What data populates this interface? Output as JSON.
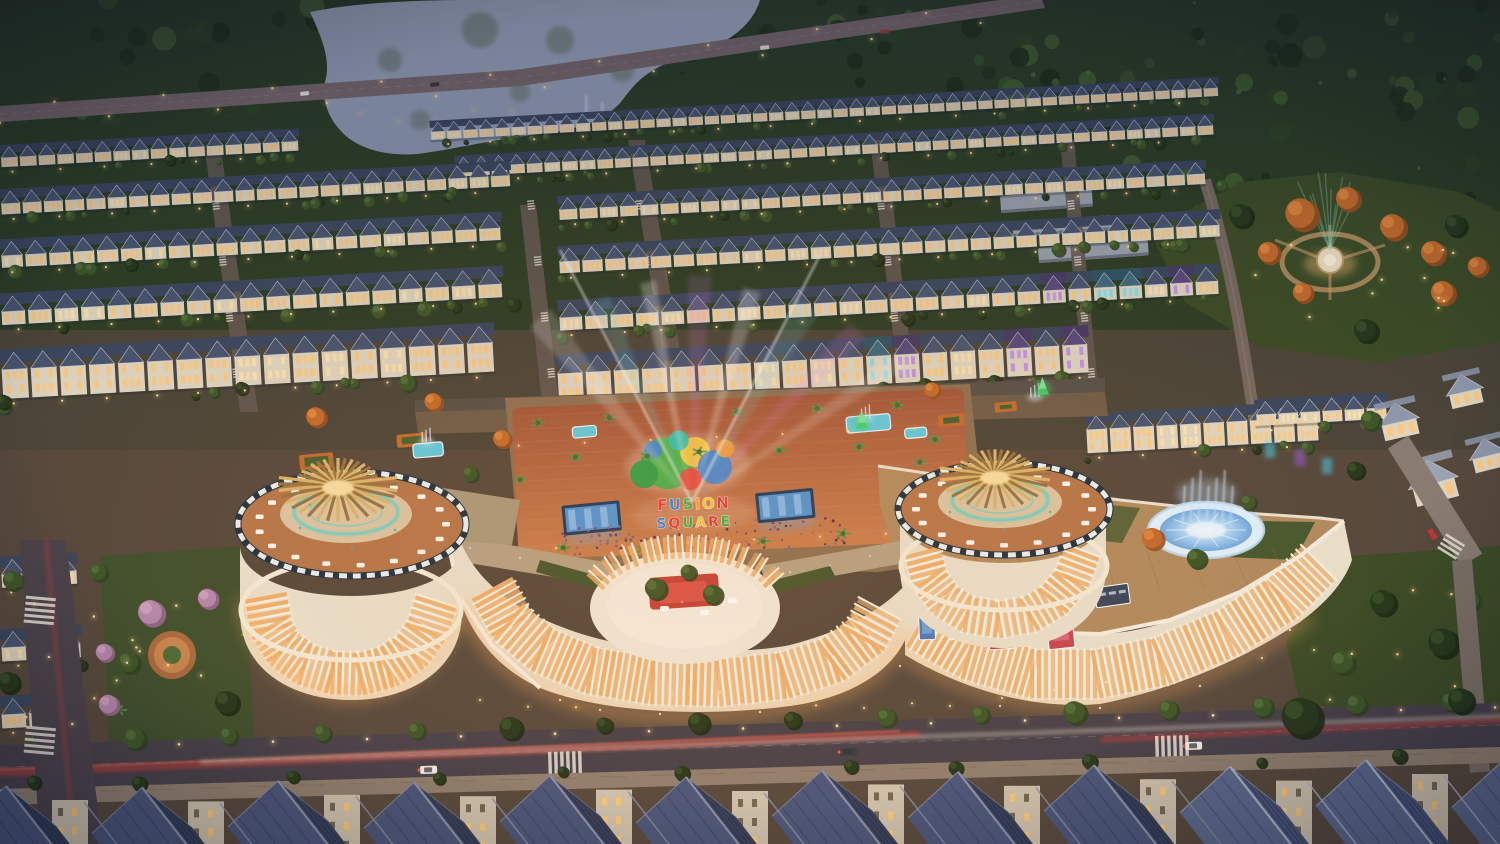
{
  "plaza_sign": {
    "line1": {
      "text": "FUSION",
      "colors": [
        "#e63832",
        "#3f86d8",
        "#3fae4a",
        "#f2a03c",
        "#f2c83c",
        "#d84038"
      ]
    },
    "line2": {
      "text": "SQUARE",
      "colors": [
        "#3f86d8",
        "#e63832",
        "#3fae4a",
        "#f2c83c",
        "#d84038",
        "#3fae4a"
      ]
    }
  },
  "palette": {
    "forest": "#2c3d24",
    "forestDark": "#22311a",
    "forestLight": "#3d5429",
    "water": "#a7b0c6",
    "waterDeep": "#8c97b2",
    "roadTop": "#7b6a6e",
    "asphalt": "#46404a",
    "sidewalk": "#8f7e6f",
    "street": "#635852",
    "trailRed": "#e03b36",
    "trailWhite": "#f5e9d2",
    "roofSlate": "#46546f",
    "roofSlateDark": "#39465e",
    "roofTrim": "#b9c0cc",
    "roofTeal": "#3c6a7d",
    "roofPurple": "#57497d",
    "facade": "#ded5c2",
    "windowWarm": "#ffc878",
    "windowPale": "#ffe2a8",
    "windowCyan": "#7ae0f0",
    "windowPurple": "#c08af0",
    "mallCream": "#e8dfcc",
    "pillar": "#f6f0e4",
    "glassWarm": "#edae6a",
    "gold": "#d9b26a",
    "goldDark": "#97743f",
    "tealGlow": "#3fd4d8",
    "terracotta": "#b5764a",
    "terraceInner": "#d9c4a2",
    "deckWood": "#b08a5f",
    "fountainRim": "#dff0fc",
    "fountainBlue": "#8cc4ee",
    "fountainCore": "#eaf6ff",
    "plazaBrick": "#a0563a",
    "plazaBrickLight": "#c97e4e",
    "ledScreen": "#1e3a5c",
    "ledScreenLight": "#4f94d4",
    "lampGlow": "#ffd080",
    "lawn": "#3b4b26",
    "lawnLit": "#51603a",
    "treeGreen": "#3c5529",
    "treeDark": "#26371c",
    "treeAutumn": "#c06a2c",
    "blossom": "#b486ac",
    "fgRoofL": "#49557a",
    "fgRoofR": "#333e5c",
    "fgRoofLightL": "#5a678c",
    "fgRoofLightR": "#47537a",
    "fgCap": "#8891a6",
    "fgCapLight": "#aab2c4",
    "crowd": "#5a3f63",
    "poolAqua": "#5fc8dc",
    "planterOrange": "#c26a30",
    "billboardWhite": "#f2f0ec",
    "billboardRed": "#b83a42",
    "billboardPink": "#c8454f",
    "billboardPanel": "#39465a",
    "ledTree": "#3fd06a"
  }
}
